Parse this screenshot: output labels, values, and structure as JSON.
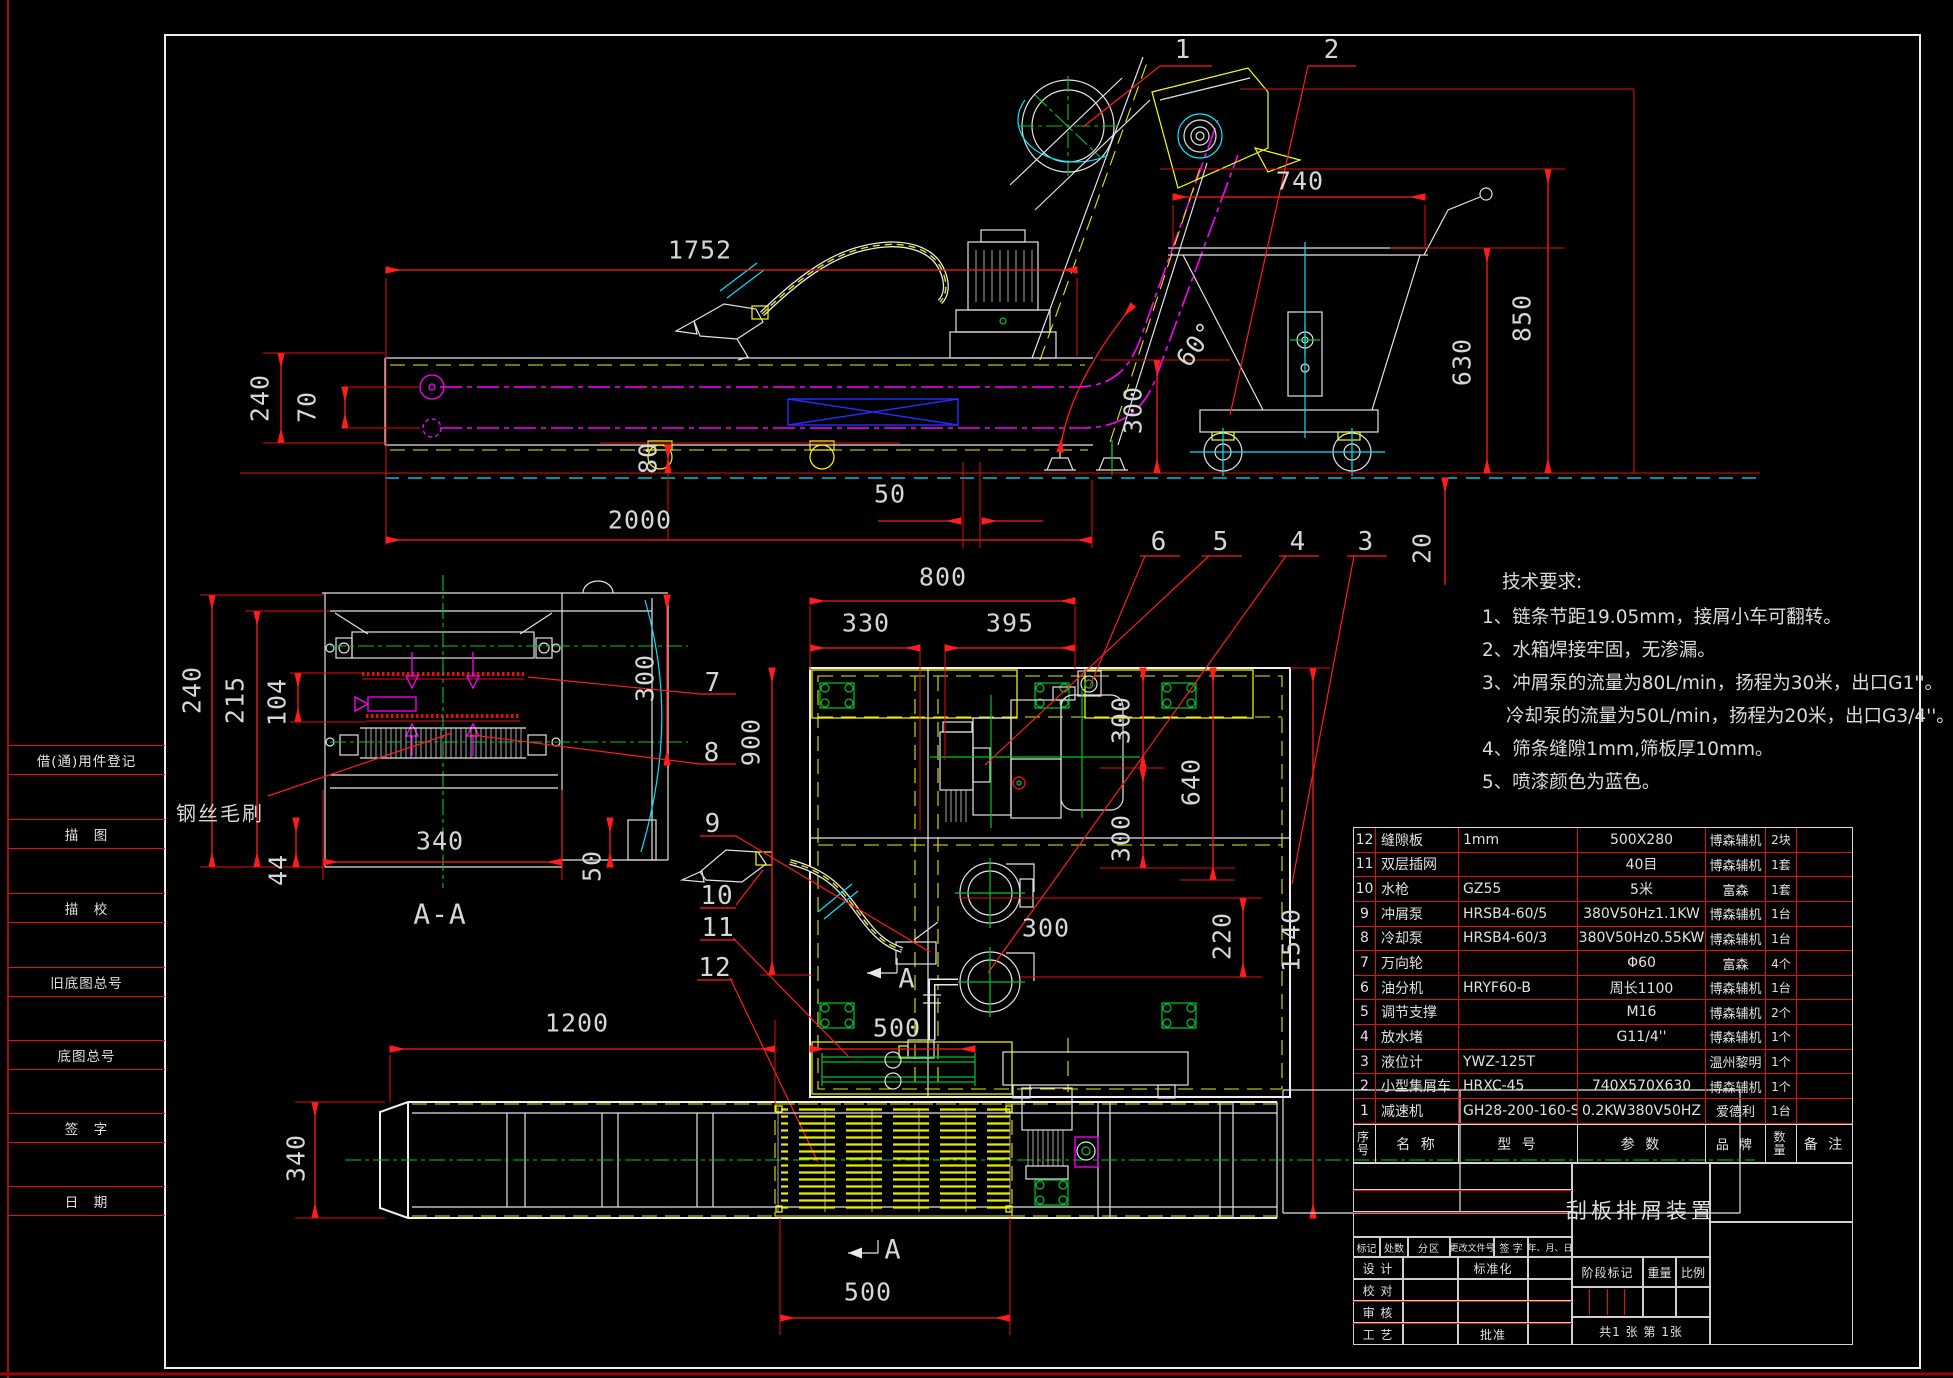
{
  "drawing": {
    "title": "刮板排屑装置",
    "sheet": "共1  张  第  1张"
  },
  "labels": {
    "section_aa": "A-A",
    "brush": "钢丝毛刷",
    "section_a_mid": "A",
    "section_a_bottom": "A"
  },
  "dims": {
    "len1752": "1752",
    "cart740": "740",
    "h850": "850",
    "h630": "630",
    "conv240": "240",
    "off70": "70",
    "h300": "300",
    "h80": "80",
    "len2000": "2000",
    "off50": "50",
    "ang60": "60°",
    "gap20": "20",
    "aa240": "240",
    "aa215": "215",
    "aa104": "104",
    "aa300": "300",
    "aa340": "340",
    "aa44": "44",
    "aa50": "50",
    "plan800": "800",
    "plan330": "330",
    "plan395": "395",
    "plan900": "900",
    "plan300a": "300",
    "plan640": "640",
    "plan300b": "300",
    "plan300c": "300",
    "plan220": "220",
    "plan1540": "1540",
    "plan500": "500",
    "bot1200": "1200",
    "bot340": "340",
    "bot500": "500"
  },
  "callouts": {
    "c1": "1",
    "c2": "2",
    "c3": "3",
    "c4": "4",
    "c5": "5",
    "c6": "6",
    "c7": "7",
    "c8": "8",
    "c9": "9",
    "c10": "10",
    "c11": "11",
    "c12": "12"
  },
  "tech": {
    "title": "技术要求:",
    "lines": [
      "1、链条节距19.05mm，接屑小车可翻转。",
      "2、水箱焊接牢固，无渗漏。",
      "3、冲屑泵的流量为80L/min，扬程为30米，出口G1''。",
      "冷却泵的流量为50L/min，扬程为20米，出口G3/4''。",
      "4、筛条缝隙1mm,筛板厚10mm。",
      "5、喷漆颜色为蓝色。"
    ]
  },
  "bom": {
    "headers": {
      "no": "序号",
      "name": "名  称",
      "model": "型  号",
      "param": "参  数",
      "brand": "品  牌",
      "qty": "数量",
      "note": "备 注"
    },
    "rows": [
      {
        "no": "12",
        "name": "缝隙板",
        "model": "1mm",
        "param": "500X280",
        "brand": "博森辅机",
        "qty": "2块",
        "note": ""
      },
      {
        "no": "11",
        "name": "双层插网",
        "model": "",
        "param": "40目",
        "brand": "博森辅机",
        "qty": "1套",
        "note": ""
      },
      {
        "no": "10",
        "name": "水枪",
        "model": "GZ55",
        "param": "5米",
        "brand": "富森",
        "qty": "1套",
        "note": ""
      },
      {
        "no": "9",
        "name": "冲屑泵",
        "model": "HRSB4-60/5",
        "param": "380V50Hz1.1KW",
        "brand": "博森辅机",
        "qty": "1台",
        "note": ""
      },
      {
        "no": "8",
        "name": "冷却泵",
        "model": "HRSB4-60/3",
        "param": "380V50Hz0.55KW",
        "brand": "博森辅机",
        "qty": "1台",
        "note": ""
      },
      {
        "no": "7",
        "name": "万向轮",
        "model": "",
        "param": "Φ60",
        "brand": "富森",
        "qty": "4个",
        "note": ""
      },
      {
        "no": "6",
        "name": "油分机",
        "model": "HRYF60-B",
        "param": "周长1100",
        "brand": "博森辅机",
        "qty": "1台",
        "note": ""
      },
      {
        "no": "5",
        "name": "调节支撑",
        "model": "",
        "param": "M16",
        "brand": "博森辅机",
        "qty": "2个",
        "note": ""
      },
      {
        "no": "4",
        "name": "放水堵",
        "model": "",
        "param": "G11/4''",
        "brand": "博森辅机",
        "qty": "1个",
        "note": ""
      },
      {
        "no": "3",
        "name": "液位计",
        "model": "YWZ-125T",
        "param": "",
        "brand": "温州黎明",
        "qty": "1个",
        "note": ""
      },
      {
        "no": "2",
        "name": "小型集屑车",
        "model": "HRXC-45",
        "param": "740X570X630",
        "brand": "博森辅机",
        "qty": "1个",
        "note": ""
      },
      {
        "no": "1",
        "name": "减速机",
        "model": "GH28-200-160-S",
        "param": "0.2KW380V50HZ",
        "brand": "爱德利",
        "qty": "1台",
        "note": ""
      }
    ]
  },
  "title_block": {
    "mark": "标记",
    "count": "处数",
    "zone": "分区",
    "change_doc": "更改文件号",
    "sign": "签 字",
    "date": "年、月、日",
    "design": "设 计",
    "check": "校 对",
    "review": "审 核",
    "process": "工 艺",
    "standard": "标准化",
    "approve": "批准",
    "stage_mark": "阶段标记",
    "weight": "重量",
    "scale": "比例"
  },
  "sidebar": {
    "items": [
      "借(通)用件登记",
      "描　图",
      "描　校",
      "旧底图总号",
      "底图总号",
      "签　字",
      "日　期"
    ]
  }
}
